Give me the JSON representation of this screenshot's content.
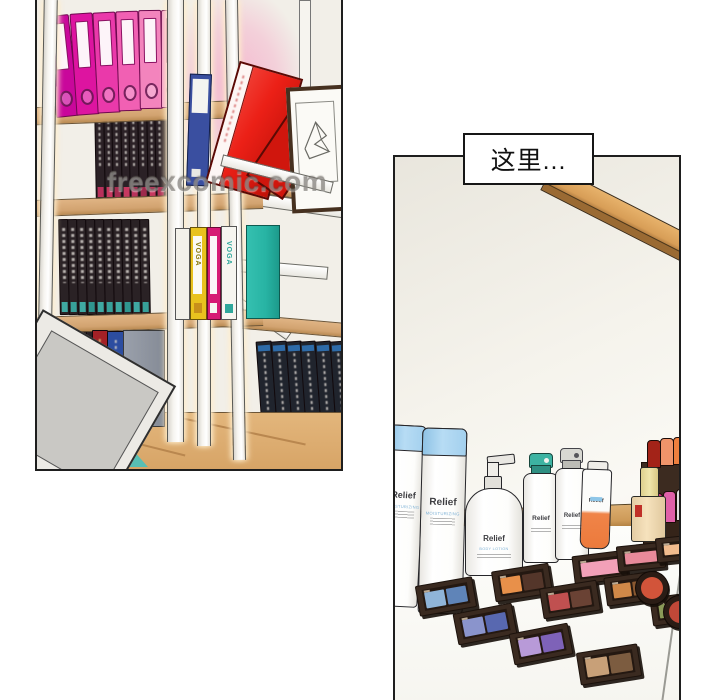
{
  "page": {
    "watermark": "freexcomic.com",
    "background_color": "#ffffff",
    "panel_border_color": "#1e1e1e"
  },
  "speech_bubble": {
    "text": "这里..."
  },
  "brands": {
    "skincare_brand": "Relief",
    "skincare_sub": "MOISTURIZING",
    "pump_sub": "BODY LOTION",
    "binder_brand": "VOGA"
  },
  "palette_accent_colors": {
    "wood": "#d2a370",
    "wall_cream": "#f2efe8",
    "pink_glow": "#f4b7ce",
    "red_binder": "#ec2017",
    "teal_box": "#2bb3a4",
    "blue_cap": "#aed7f2"
  },
  "left_panel": {
    "binders": [
      {
        "x": 14,
        "y": 15,
        "w": 21,
        "h": 100,
        "rot": -6,
        "c": "#c9079b"
      },
      {
        "x": 36,
        "y": 13,
        "w": 21,
        "h": 100,
        "rot": -4,
        "c": "#dd14a0"
      },
      {
        "x": 58,
        "y": 12,
        "w": 21,
        "h": 99,
        "rot": -3,
        "c": "#ea39aa"
      },
      {
        "x": 80,
        "y": 11,
        "w": 21,
        "h": 98,
        "rot": -2,
        "c": "#f160b3"
      },
      {
        "x": 102,
        "y": 10,
        "w": 21,
        "h": 97,
        "rot": -1,
        "c": "#f384bd"
      },
      {
        "x": 124,
        "y": 10,
        "w": 21,
        "h": 96,
        "rot": 0,
        "c": "#f5a0c9"
      }
    ],
    "book_rows": [
      {
        "x": 58,
        "y": 106,
        "w": 8,
        "h": 92,
        "gap": 0.6,
        "rot": -1,
        "band_h": 10,
        "dark": "#2b2126",
        "text": true,
        "bands": [
          "#b8315b",
          "#c73960",
          "#a42c50",
          "#c73960",
          "#b8315b",
          "#9e2a4c",
          "#c73960",
          "#b03156",
          "#c2385e"
        ]
      },
      {
        "x": 22,
        "y": 219,
        "w": 8.4,
        "h": 94,
        "gap": 0.6,
        "rot": -1,
        "band_h": 10,
        "dark": "#2a2225",
        "text": true,
        "bands": [
          "#3fa9a2",
          "#37a099",
          "#3fa9a2",
          "#2f968f",
          "#3fa9a2",
          "#37a099",
          "#3fa9a2",
          "#2f968f",
          "#3fa9a2",
          "#37a099"
        ]
      },
      {
        "x": 15,
        "y": 331,
        "w": 8,
        "h": 94,
        "gap": 0.6,
        "rot": 0,
        "band_h": 9,
        "dark": "#272025",
        "text": true,
        "bands": [
          "#3a8f9a",
          "#7a2f5a",
          "#2f968f",
          "#8a3152",
          "#3a8f9a"
        ]
      },
      {
        "x": 223,
        "y": 341,
        "w": 14,
        "h": 126,
        "gap": 0.8,
        "rot": -4,
        "band_h": 9,
        "dark": "#20242d",
        "text": true,
        "top_band": "#2e6ba8",
        "bands": [
          "#2e6ba8",
          "#2e6ba8",
          "#2e6ba8",
          "#2e6ba8",
          "#2e6ba8",
          "#2e6ba8"
        ]
      }
    ]
  },
  "right_panel": {
    "palettes": [
      {
        "x": 286,
        "y": 372,
        "w": 40,
        "rot": -6,
        "pans": [
          "#e89050"
        ]
      },
      {
        "x": 178,
        "y": 396,
        "w": 52,
        "rot": -7,
        "pans": [
          "#f2a0b8"
        ]
      },
      {
        "x": 222,
        "y": 387,
        "w": 46,
        "rot": -6,
        "pans": [
          "#e88a9a"
        ]
      },
      {
        "x": 261,
        "y": 379,
        "w": 44,
        "rot": -6,
        "pans": [
          "#f2bc8e"
        ]
      },
      {
        "x": 22,
        "y": 424,
        "w": 56,
        "rot": -10,
        "pans": [
          "#8fb4d8",
          "#5f84b8"
        ]
      },
      {
        "x": 98,
        "y": 410,
        "w": 56,
        "rot": -9,
        "pans": [
          "#e8904a",
          "#54362a"
        ]
      },
      {
        "x": 146,
        "y": 427,
        "w": 56,
        "rot": -9,
        "pans": [
          "#c05050",
          "#6a4234"
        ]
      },
      {
        "x": 210,
        "y": 417,
        "w": 52,
        "rot": -8,
        "pans": [
          "#d08848",
          "#8a5830"
        ]
      },
      {
        "x": 256,
        "y": 437,
        "w": 52,
        "rot": -8,
        "pans": [
          "#8a9a58",
          "#50603a"
        ]
      },
      {
        "x": 60,
        "y": 451,
        "w": 58,
        "rot": -11,
        "pans": [
          "#8a94cc",
          "#5868b0"
        ]
      },
      {
        "x": 116,
        "y": 471,
        "w": 58,
        "rot": -11,
        "pans": [
          "#b89ad8",
          "#7e62b8"
        ]
      },
      {
        "x": 183,
        "y": 491,
        "w": 60,
        "rot": -9,
        "pans": [
          "#c8a078",
          "#7c5c40"
        ]
      }
    ],
    "compacts": [
      {
        "x": 240,
        "y": 414,
        "d": 32,
        "pan": "#d2543a"
      },
      {
        "x": 268,
        "y": 438,
        "d": 32,
        "pan": "#c04838"
      }
    ],
    "lipsticks": [
      {
        "x": 252,
        "y": 283,
        "w": 12,
        "h": 26,
        "c": "#a32318"
      },
      {
        "x": 265,
        "y": 281,
        "w": 12,
        "h": 26,
        "c": "#f0946a"
      },
      {
        "x": 278,
        "y": 280,
        "w": 12,
        "h": 26,
        "c": "#ef7f3e"
      },
      {
        "x": 255,
        "y": 336,
        "w": 11,
        "h": 30,
        "c": "#d23486"
      },
      {
        "x": 268,
        "y": 334,
        "w": 11,
        "h": 30,
        "c": "#e060a8"
      },
      {
        "x": 281,
        "y": 332,
        "w": 11,
        "h": 30,
        "c": "#e2e2e0"
      }
    ]
  }
}
